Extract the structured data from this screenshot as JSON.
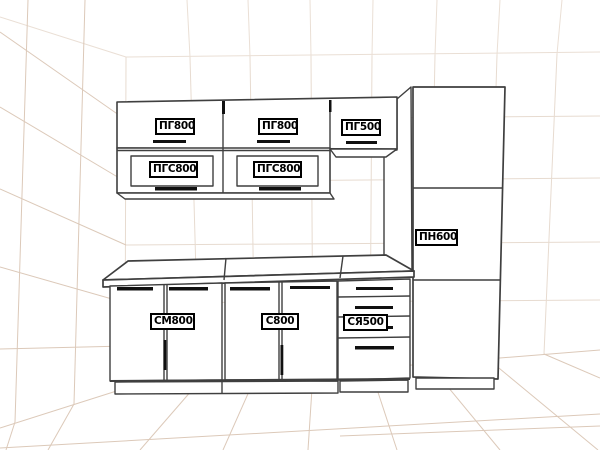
{
  "scene": {
    "description": "Perspective line drawing of a kitchen cabinet set inside a gridded room",
    "colors": {
      "background": "#ffffff",
      "grid_wall": "#eadfd5",
      "grid_floor": "#dcc9b9",
      "cabinet_outline": "#3f3f3f",
      "handle": "#101010",
      "label_background": "#ffffff",
      "label_border": "#000000",
      "label_text": "#000000"
    },
    "cabinets": {
      "wall": [
        {
          "code": "ПГ800"
        },
        {
          "code": "ПГ800"
        },
        {
          "code": "ПГ500"
        },
        {
          "code": "ПГС800"
        },
        {
          "code": "ПГС800"
        }
      ],
      "tall": {
        "code": "ПН600"
      },
      "base": [
        {
          "code": "СМ800"
        },
        {
          "code": "С800"
        },
        {
          "code": "СЯ500"
        }
      ]
    }
  }
}
